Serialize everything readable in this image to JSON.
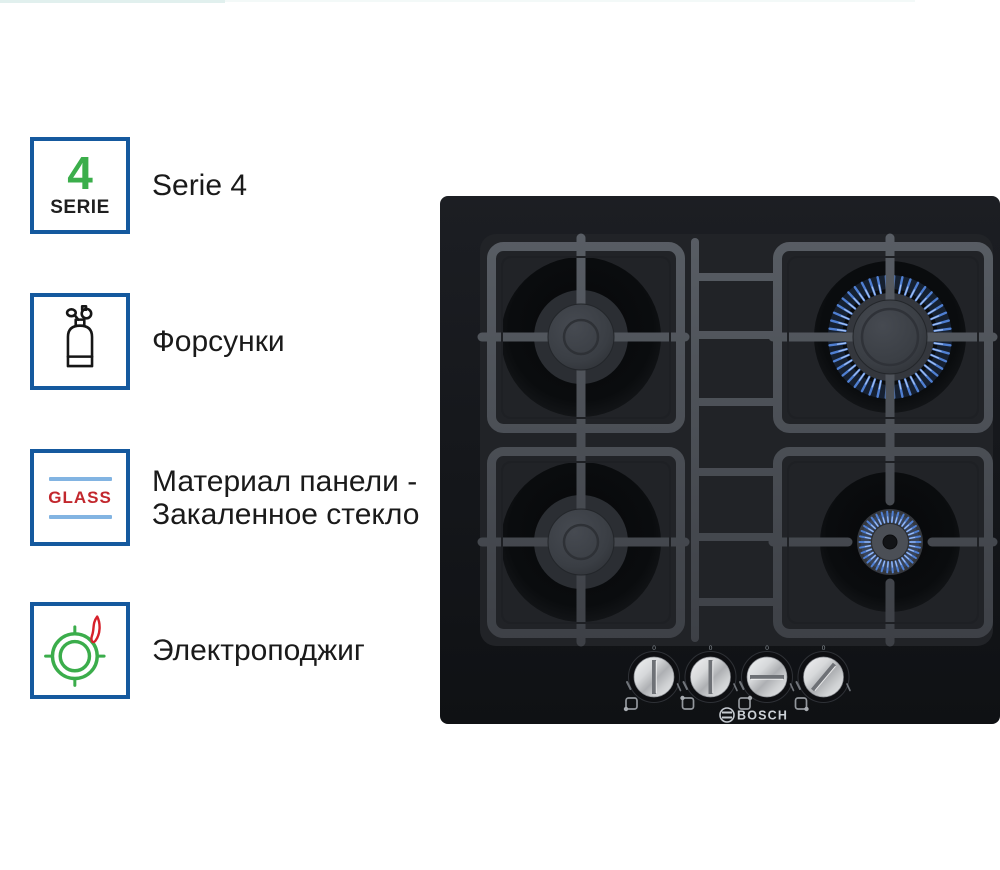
{
  "page": {
    "background": "#ffffff"
  },
  "colors": {
    "badge-border": "#15599e",
    "serie-green": "#3bae4b",
    "glass-red": "#c2272d",
    "glass-blue": "#82b4e2",
    "ignition-green": "#3bad4b",
    "flame-red": "#d6202a",
    "label-text": "#1a1a1a",
    "flame-blue": "#4f7fd2",
    "flame-blue-bright": "#a6c2f3",
    "bosch-logo": "#ccd1d7"
  },
  "features": [
    {
      "type": "serie-badge",
      "badge_number": "4",
      "badge_caption": "SERIE",
      "label": "Serie 4"
    },
    {
      "type": "gas-cylinder",
      "label": "Форсунки"
    },
    {
      "type": "glass",
      "glass_text": "GLASS",
      "label_line1": "Материал панели -",
      "label_line2": "Закаленное стекло"
    },
    {
      "type": "electric-ignition",
      "label": "Электроподжиг"
    }
  ],
  "hob": {
    "brand": "BOSCH",
    "burners": [
      {
        "position": "back-left",
        "size": "medium",
        "lit": false
      },
      {
        "position": "back-right",
        "size": "large",
        "lit": true
      },
      {
        "position": "front-left",
        "size": "medium",
        "lit": false
      },
      {
        "position": "front-right",
        "size": "small",
        "lit": true
      }
    ],
    "knobs": [
      {
        "zero_label": "0",
        "rotation_deg": 0,
        "burner_dot": "bottom-left"
      },
      {
        "zero_label": "0",
        "rotation_deg": 0,
        "burner_dot": "top-left"
      },
      {
        "zero_label": "0",
        "rotation_deg": 90,
        "burner_dot": "top-right"
      },
      {
        "zero_label": "0",
        "rotation_deg": 40,
        "burner_dot": "bottom-right"
      }
    ]
  }
}
